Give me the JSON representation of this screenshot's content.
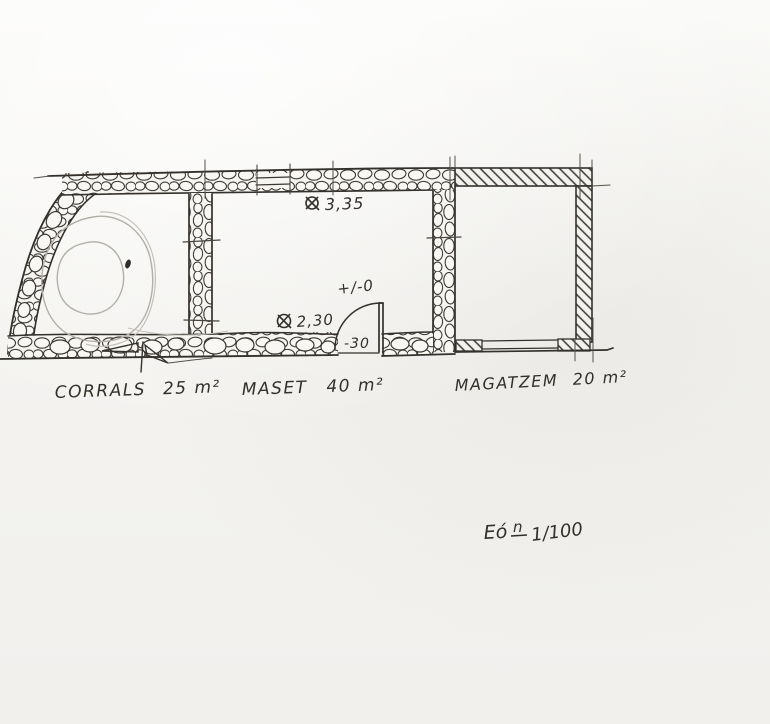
{
  "title": "Hand-drawn stone farmhouse floor plan sketch",
  "rooms": [
    {
      "name": "corrals",
      "label": "CORRALS",
      "area": "25 m²"
    },
    {
      "name": "maset",
      "label": "MASET",
      "area": "40 m²"
    },
    {
      "name": "magatzem",
      "label": "MAGATZEM",
      "area": "20 m²"
    }
  ],
  "annotations": {
    "height_main": "3,35",
    "height_door": "2,30",
    "level_zero": "+/-0",
    "level_step": "-30"
  },
  "scale_note": {
    "prefix": "Eó",
    "sup": "n",
    "ratio": "1/100"
  },
  "colors": {
    "paper": "#f5f4f1",
    "ink": "#33302c",
    "pencil": "#b3afa8",
    "stone_fill": "#f7f6f3"
  }
}
